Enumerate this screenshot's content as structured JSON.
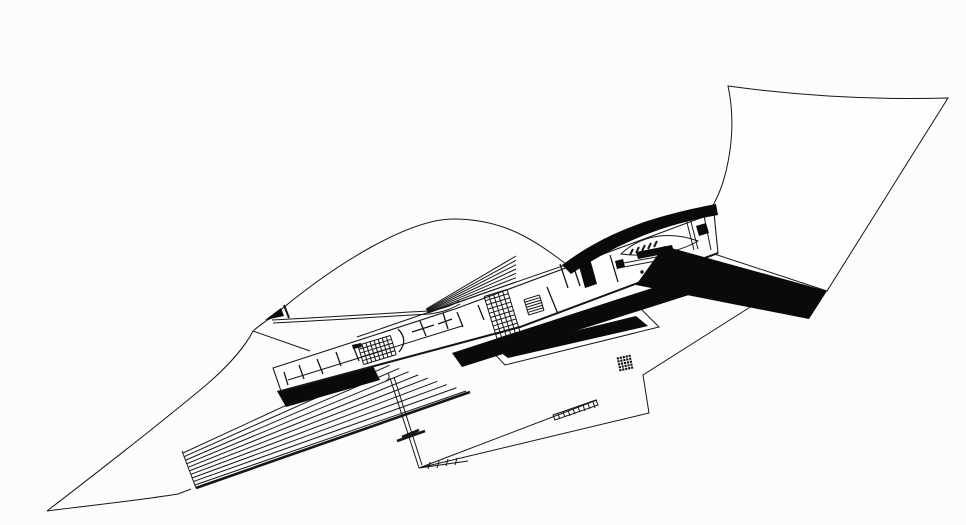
{
  "palette": {
    "background": "#fcfcfc",
    "ink": "#161616",
    "solid_black": "#0a0a0a",
    "paper_white": "#fefefe"
  },
  "drawing": {
    "paths": {
      "site_top_curve": "M 47,511 C 90,478 152,430 205,386 C 233,362 247,343 253,331 C 259,326 265,321 271,318",
      "site_bottom_curve": "M 47,511 C 85,506 135,501 178,494 L 191,489",
      "junction_line": "M 253,331 L 310,351",
      "zigzag_boundary": "M 755,304 L 643,375 L 649,413 L 419,468 M 419,468 L 597,400 M 419,468 L 468,461",
      "bottom_ticks": "M 428,469 L 430,462 M 437,468 L 439,461 M 446,466 L 448,459 M 455,465 L 457,458",
      "diag_double_line": "M 390,378 L 419,468 M 394,377 L 422,465",
      "diag_thick_ticks": "M 397,441 L 425,431 M 402,437 L 419,430",
      "diag_s_mark": "M 386,381 Q 391,378 388,373",
      "ramp_cut": "M 182,451 L 196,488",
      "ramp_bottom_edge": "M 196,488 L 470,392",
      "ramp_black_wedge": "M 277,391 L 373,366 L 380,380 L 286,407 Z",
      "band_c_outline": "M 487,346 L 641,309 L 659,327 L 505,365 Z",
      "band_c_fill": "M 497,350 L 636,316 L 648,326 L 508,358 Z",
      "shadow_b": "M 452,353 L 680,279 L 692,294 L 462,367 Z",
      "band_a": "M 664,246 L 827,291 L 809,319 L 636,285 Z",
      "sail_outline": "M 728,86 Q 838,101 948,98 L 827,291 L 690,246 Q 699,216 712,207 C 727,182 738,132 728,86 Z",
      "black_curve_wedge": "M 562,265 C 605,233 648,217 716,204 L 718,215 C 655,226 612,247 571,274 Z",
      "arc_main": "M 271,318 C 340,259 412,219 453,219 C 503,219 533,239 566,264",
      "leaf_double_curve": "M 272,320 C 335,317 390,313 428,311 C 444,309 453,305 459,301 M 273,323 C 335,320 392,316 429,314 C 445,312 453,308 460,304",
      "flag_triangle": "M 265,320 L 281,308 L 284,316 Z",
      "flag_tick": "M 284,305 L 289,318",
      "building_outline": "M 273,368 L 455,309 L 714,213 L 718,253 L 520,327 L 281,391 Z",
      "building_bottom_heavy": "M 281,391 L 520,327 L 718,253",
      "building_spine": "M 288,380 L 462,326",
      "building_inner_top": "M 357,337 L 606,251",
      "left_end_ticks": "M 284,372 L 288,385 M 299,365 L 304,379 M 317,359 L 323,374 M 336,352 L 341,366 M 353,346 L 359,361",
      "tick_flag_rect": "M 352,345 L 361,343 L 362,347 L 353,349 Z",
      "arc_wall": "M 398,329 Q 409,340 399,352",
      "plus_walls": "M 412,332 L 434,325 M 420,321 L 426,336 M 438,324 L 452,319 M 443,313 L 448,329",
      "mid_ticks": "M 457,312 L 463,327 M 478,305 L 484,320",
      "black_column": "M 577,259 L 589,255 L 597,284 L 585,288 Z",
      "column_partitions": "M 560,264 L 568,288 M 572,262 L 580,286 M 547,287 L 558,314 M 610,255 L 618,282",
      "wall_double": "M 618,268 L 678,257 M 618,264 L 678,253",
      "wall_black_bar": "M 636,252 L 672,245 L 674,252 L 638,259 Z",
      "wall_small_sq": "M 615,261 L 623,259 L 625,267 L 617,269 Z",
      "comb_ticks": "M 630,255 L 633,249 M 636,253 L 639,247 M 642,251 L 645,245 M 648,249 L 651,243 M 654,247 L 657,241",
      "lens_room": "M 621,254 C 640,236 668,230 698,241 C 676,254 645,257 621,254 Z",
      "partition_double": "M 686,219 L 694,250 M 690,218 L 698,249 M 704,216 L 711,250",
      "end_black_sq": "M 696,226 L 706,223 L 709,233 L 699,236 Z",
      "ladder_strip_outline": "M 553,415 L 596,400 L 598,405 L 555,420 Z",
      "ladder_strip_ticks": "M 558,414 L 560,419 M 563,412 L 565,417 M 568,410 L 570,416 M 573,409 L 575,414 M 578,407 L 580,412 M 583,405 L 585,411 M 588,404 L 590,409 M 593,402 L 595,408"
    },
    "stripe_sets": [
      {
        "name": "ramp-stripes",
        "from_a": [
          183,
          453
        ],
        "from_b": [
          195,
          485
        ],
        "to_a": [
          380,
          362
        ],
        "to_b": [
          466,
          391
        ],
        "count": 10,
        "width": 1
      },
      {
        "name": "fan-stripes",
        "from_a": [
          426,
          309
        ],
        "from_b": [
          428,
          313
        ],
        "to_a": [
          516,
          256
        ],
        "to_b": [
          516,
          282
        ],
        "count": 7,
        "width": 1
      }
    ],
    "grids": [
      {
        "name": "waffle-block-a",
        "cx": 377,
        "cy": 350,
        "w": 34,
        "h": 20,
        "cols": 8,
        "rows": 5,
        "angle": -17,
        "stroke": "#161616",
        "width": 1,
        "fill": "none"
      },
      {
        "name": "waffle-block-b",
        "cx": 502,
        "cy": 314,
        "w": 24,
        "h": 44,
        "cols": 5,
        "rows": 10,
        "angle": -17,
        "stroke": "#161616",
        "width": 1,
        "fill": "none"
      },
      {
        "name": "ladder-block",
        "cx": 534,
        "cy": 305,
        "w": 16,
        "h": 16,
        "cols": 1,
        "rows": 6,
        "angle": -17,
        "stroke": "#161616",
        "width": 1,
        "fill": "none"
      },
      {
        "name": "waffle-square",
        "cx": 625,
        "cy": 363,
        "w": 15,
        "h": 15,
        "cols": 5,
        "rows": 5,
        "angle": -12,
        "stroke": "#ffffff",
        "width": 0.9,
        "fill": "#0a0a0a"
      }
    ],
    "dots": [
      {
        "cx": 642,
        "cy": 272,
        "r": 1.7
      },
      {
        "cx": 650,
        "cy": 270,
        "r": 1.7
      },
      {
        "cx": 657,
        "cy": 268,
        "r": 1.7
      },
      {
        "cx": 665,
        "cy": 266,
        "r": 1.7
      }
    ]
  }
}
